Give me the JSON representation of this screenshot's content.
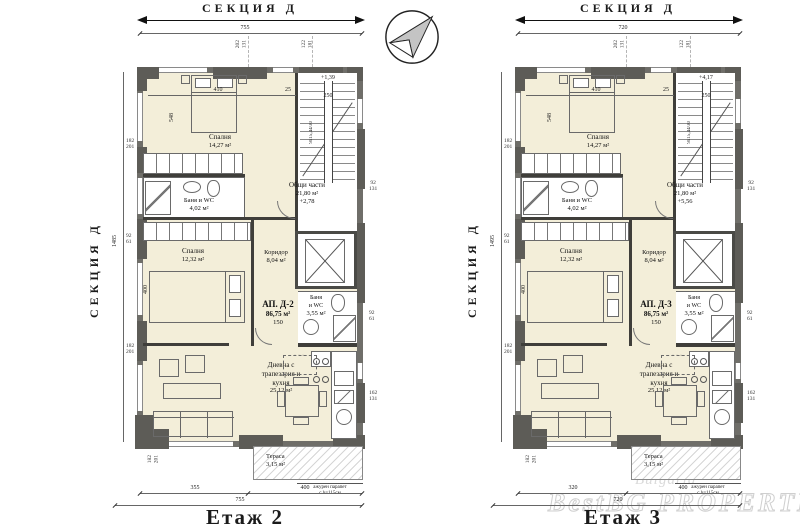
{
  "watermark": {
    "l1": "Bulgaria",
    "l2": "BestBG PROPERTIES"
  },
  "plans": [
    {
      "section_label": "СЕКЦИЯ Д",
      "side_label": "СЕКЦИЯ Д",
      "title": "Етаж 2",
      "apartment": {
        "name": "АП. Д-2",
        "area": "86,75 м²",
        "len": "150"
      },
      "rooms": {
        "bedroom1": {
          "name": "Спалня",
          "area": "14,27 м²"
        },
        "bath1": {
          "name": "Баня и WC",
          "area": "4,02 м²"
        },
        "common": {
          "name": "Общи части",
          "area": "21,80 м²",
          "elev": "+2,78"
        },
        "stair": {
          "elev": "+1,39",
          "width": "250",
          "note": "9x15,44/30"
        },
        "bedroom2": {
          "name": "Спалня",
          "area": "12,32 м²"
        },
        "corridor": {
          "name": "Коридор",
          "area": "8,04 м²"
        },
        "bath2": {
          "l1": "Баня",
          "l2": "и WC",
          "area": "3,55 м²"
        },
        "living": {
          "l1": "Дневна с",
          "l2": "трапезария и",
          "l3": "кухня",
          "area": "25,12 м²"
        },
        "terrace": {
          "name": "Тераса",
          "area": "3,15 м²"
        }
      },
      "railing": {
        "l1": "ажурен парапет",
        "l2": "с h=115см"
      },
      "dims": {
        "top_total": "755",
        "side_total": "1485",
        "top_pairs": [
          "202",
          "131",
          "122",
          "181"
        ],
        "side_pairs": [
          "182",
          "201",
          "92",
          "61",
          "182",
          "201"
        ],
        "right_pairs": [
          "92",
          "131",
          "92",
          "61",
          "162",
          "131"
        ],
        "bottom": [
          "355",
          "400"
        ],
        "bottom_total": "755",
        "bottom_pair": [
          "182",
          "201"
        ],
        "bed_w": "410",
        "bed_gap": "25",
        "room_d": "548",
        "bed2_h": "400"
      }
    },
    {
      "section_label": "СЕКЦИЯ Д",
      "side_label": "СЕКЦИЯ Д",
      "title": "Етаж 3",
      "apartment": {
        "name": "АП. Д-3",
        "area": "86,75 м²",
        "len": "150"
      },
      "rooms": {
        "bedroom1": {
          "name": "Спалня",
          "area": "14,27 м²"
        },
        "bath1": {
          "name": "Баня и WC",
          "area": "4,02 м²"
        },
        "common": {
          "name": "Общи части",
          "area": "21,80 м²",
          "elev": "+5,56"
        },
        "stair": {
          "elev": "+4,17",
          "width": "250",
          "note": "9x15,44/30"
        },
        "bedroom2": {
          "name": "Спалня",
          "area": "12,32 м²"
        },
        "corridor": {
          "name": "Коридор",
          "area": "8,04 м²"
        },
        "bath2": {
          "l1": "Баня",
          "l2": "и WC",
          "area": "3,55 м²"
        },
        "living": {
          "l1": "Дневна с",
          "l2": "трапезария и",
          "l3": "кухня",
          "area": "25,12 м²"
        },
        "terrace": {
          "name": "Тераса",
          "area": "3,15 м²"
        }
      },
      "railing": {
        "l1": "ажурен парапет",
        "l2": "с h=115см"
      },
      "dims": {
        "top_total": "720",
        "side_total": "1495",
        "top_pairs": [
          "202",
          "131",
          "122",
          "181"
        ],
        "side_pairs": [
          "182",
          "201",
          "92",
          "61",
          "182",
          "201"
        ],
        "right_pairs": [
          "92",
          "131",
          "92",
          "61",
          "162",
          "131"
        ],
        "bottom": [
          "320",
          "400"
        ],
        "bottom_total": "720",
        "bottom_pair": [
          "182",
          "201"
        ],
        "bed_w": "410",
        "bed_gap": "25",
        "room_d": "548",
        "bed2_h": "400"
      }
    }
  ]
}
